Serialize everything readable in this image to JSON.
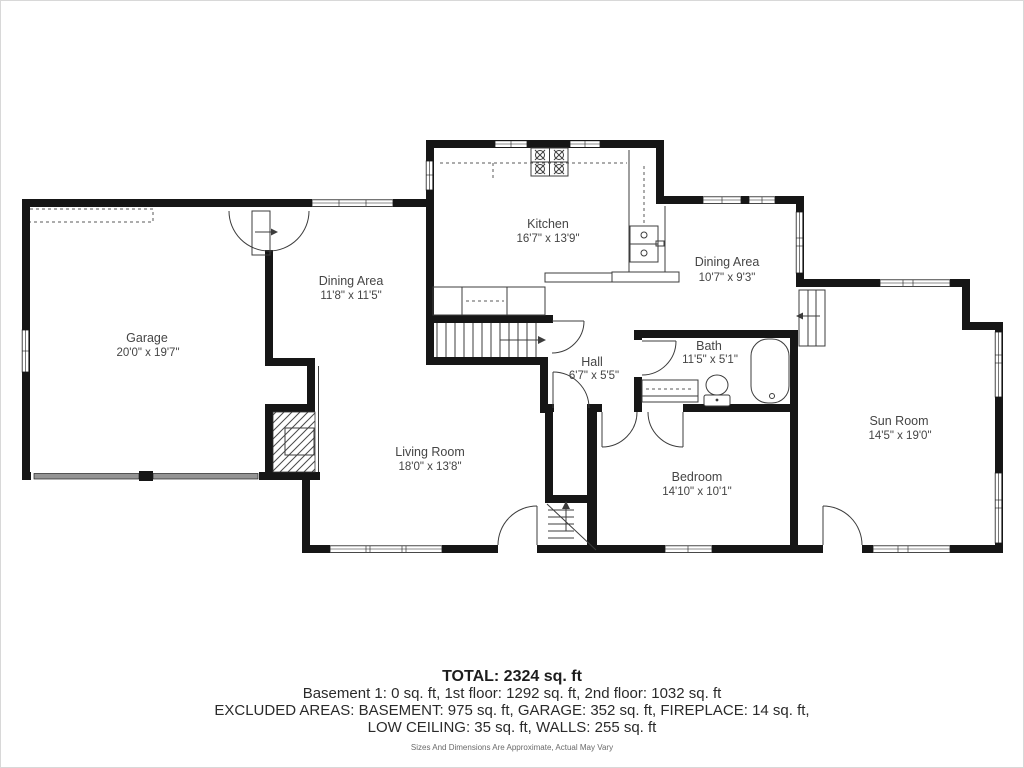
{
  "plan": {
    "rooms": [
      {
        "id": "garage",
        "name": "Garage",
        "dims": "20'0\" x 19'7\""
      },
      {
        "id": "dining-area-left",
        "name": "Dining Area",
        "dims": "11'8\" x 11'5\""
      },
      {
        "id": "kitchen",
        "name": "Kitchen",
        "dims": "16'7\" x 13'9\""
      },
      {
        "id": "dining-area-right",
        "name": "Dining Area",
        "dims": "10'7\" x 9'3\""
      },
      {
        "id": "bath",
        "name": "Bath",
        "dims": "11'5\" x 5'1\""
      },
      {
        "id": "hall",
        "name": "Hall",
        "dims": "6'7\" x 5'5\""
      },
      {
        "id": "living-room",
        "name": "Living Room",
        "dims": "18'0\" x 13'8\""
      },
      {
        "id": "bedroom",
        "name": "Bedroom",
        "dims": "14'10\" x 10'1\""
      },
      {
        "id": "sun-room",
        "name": "Sun Room",
        "dims": "14'5\" x 19'0\""
      }
    ]
  },
  "summary": {
    "total": "TOTAL: 2324 sq. ft",
    "floors": "Basement 1: 0 sq. ft, 1st floor: 1292 sq. ft, 2nd floor: 1032 sq. ft",
    "excluded_1": "EXCLUDED AREAS: BASEMENT: 975 sq. ft, GARAGE: 352 sq. ft, FIREPLACE: 14 sq. ft,",
    "excluded_2": "LOW CEILING: 35 sq. ft, WALLS: 255 sq. ft",
    "disclaimer": "Sizes And Dimensions Are Approximate, Actual May Vary"
  },
  "colors": {
    "wall": "#161616",
    "line": "#3c3c3c",
    "label": "#454545",
    "garage_door": "#949494"
  }
}
